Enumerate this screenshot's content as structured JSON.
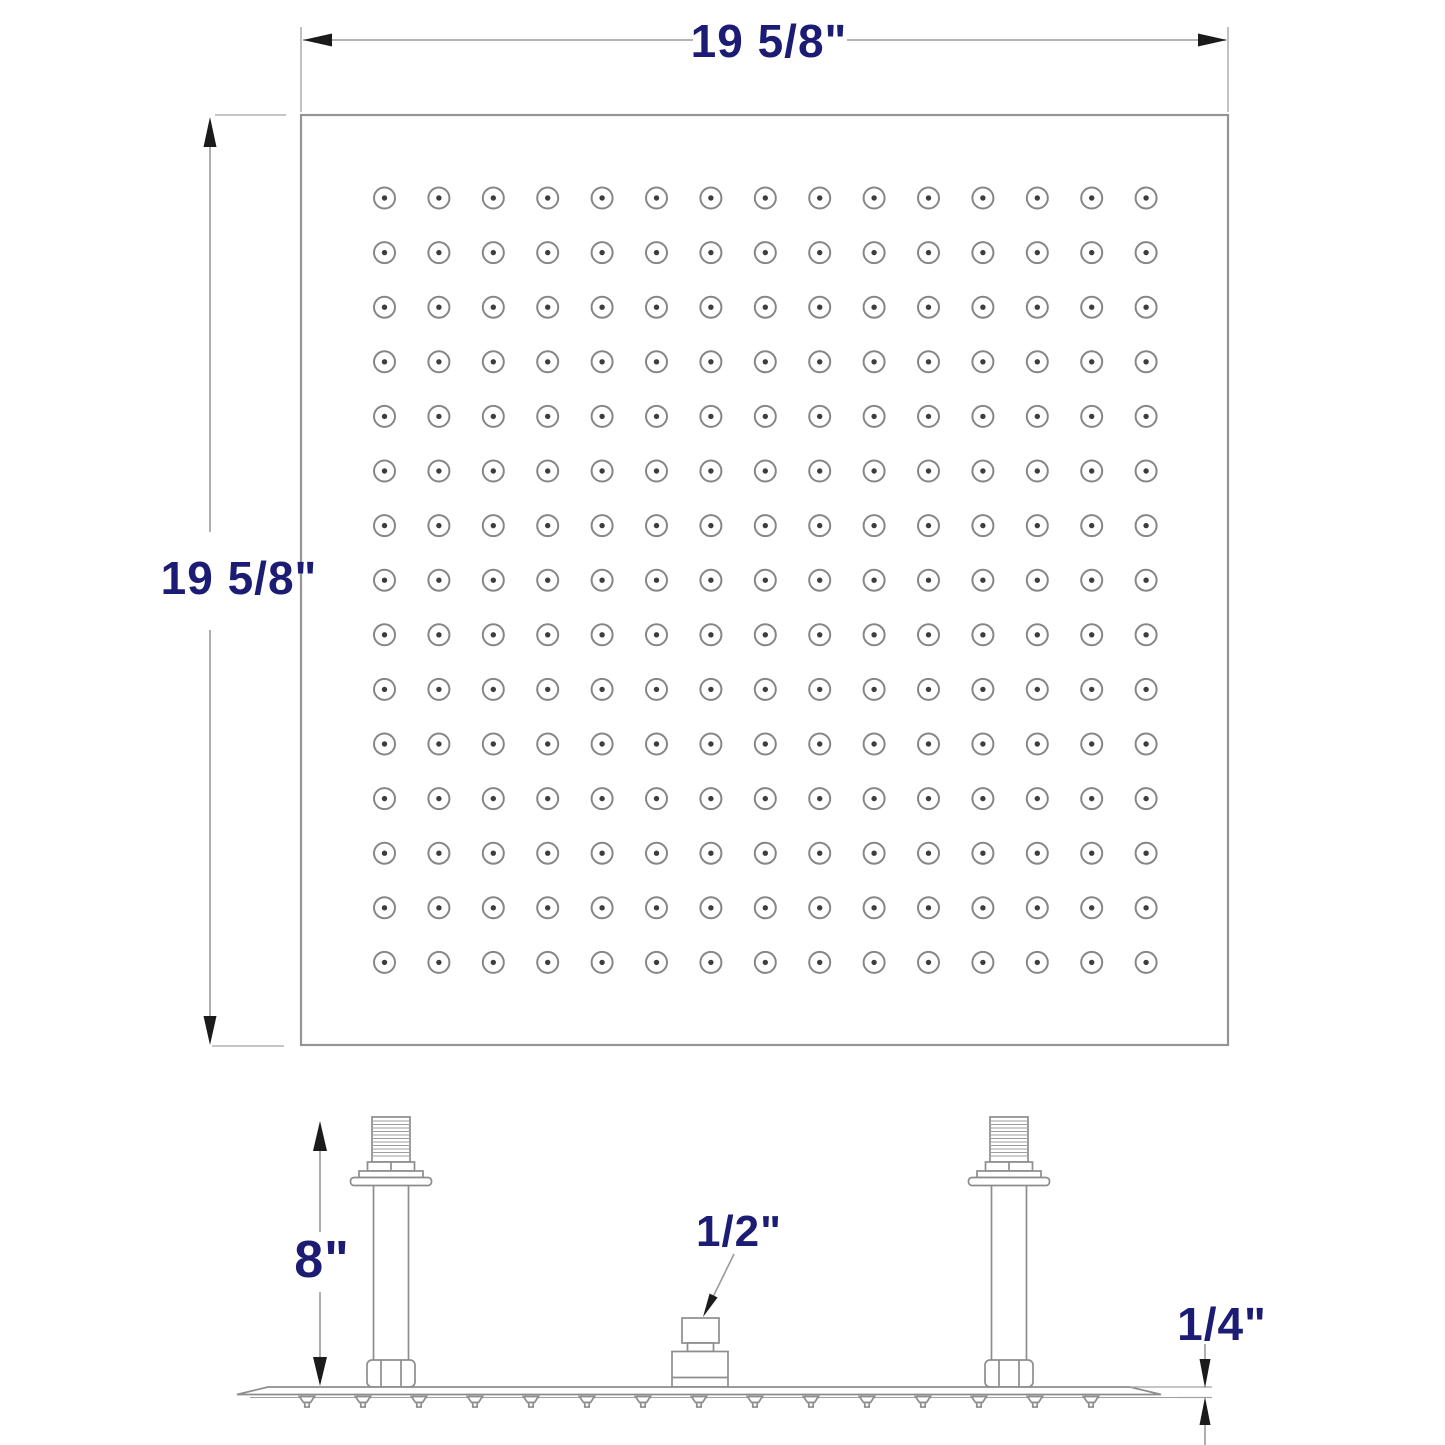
{
  "diagram": {
    "title": "Square rainfall shower head dimensional drawing",
    "colors": {
      "background": "#ffffff",
      "drawing_line": "#8d8d8d",
      "dimension_line": "#9a9a9a",
      "arrowhead": "#1b1b1b",
      "label_text": "#1c1c74"
    },
    "top_view": {
      "width_label": "19 5/8\"",
      "height_label": "19 5/8\"",
      "nozzle_grid": {
        "rows": 15,
        "columns": 15,
        "count": 225
      }
    },
    "side_view": {
      "arm_height_label": "8\"",
      "inlet_size_label": "1/2\"",
      "plate_thickness_label": "1/4\"",
      "arm_count": 2,
      "spray_nozzle_count": 15
    }
  }
}
